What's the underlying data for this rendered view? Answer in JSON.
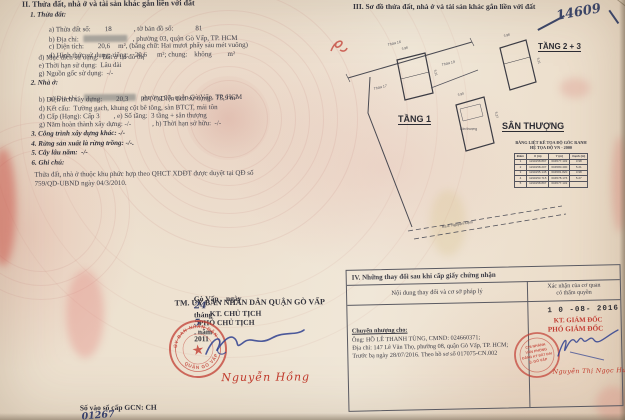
{
  "left": {
    "title": "II. Thửa đất, nhà ở và tài sản khác gắn liền với đất",
    "s1": {
      "h": "1. Thửa đất:",
      "a_l": "a) Thửa đất số:",
      "a_v": "18",
      "a_l2": ", tờ bản đồ số:",
      "a_v2": "81",
      "b_l": "b) Địa chỉ:",
      "b_post": ", phường 03, quận Gò Vấp, TP. HCM",
      "c_l": "c) Diện tích:",
      "c_v": "20,6",
      "c_post": "m², (bằng chữ: Hai mươi phẩy sáu mét vuông)",
      "d_l": "d) Hình thức sử dụng: riêng:",
      "d_v": "20,6",
      "d_post": "m²; chung:    không         m²",
      "dd": "đ) Mục đích sử dụng:  Đất ở tại đô thị",
      "e": "e) Thời hạn sử dụng:  Lâu dài",
      "g": "g) Nguồn gốc sử dụng:  -/-"
    },
    "s2": {
      "h": "2. Nhà ở:",
      "a_l": "a) Địa chỉ:",
      "a_post": "phường 03, quận Gò Vấp, TP. HCM",
      "b": "b) Diện tích xây dựng:        20,3        m², c) Diện tích sử dụng:  75,9 m²",
      "d": "d) Kết cấu:  Tường gạch, khung cột bê tông, sàn BTCT, mái tôn",
      "dd": "đ) Cấp (Hạng): Cấp 3        , e) Số tầng:  3 tầng + sân thượng",
      "g": "g) Năm hoàn thành xây dựng: -/-            , h) Thời hạn sở hữu:  -/-"
    },
    "s3": "3. Công trình xây dựng khác: -/-",
    "s4": "4. Rừng sản xuất là rừng trồng: -/-.",
    "s5": "5. Cây lâu năm:  -/-",
    "s6": "6. Ghi chú:",
    "note1": "Thửa đất, nhà ở thuộc khu phức hợp theo QHCT XDĐT được duyệt tại QĐ số",
    "note2": "759/QD-UBND ngày 04/3/2010.",
    "sign": {
      "p1": "Gò Vấp ,  ngày",
      "day": "24",
      "p2": "tháng",
      "month": "5",
      "p3": ". năm",
      "year": "2011",
      "authority": "TM. ỦY BAN NHÂN DÂN QUẬN GÒ VẤP",
      "title1": "KT. CHỦ TỊCH",
      "title2": "PHÓ CHỦ TỊCH",
      "name": "Nguyễn Hồng",
      "seal_top": "ỦY BAN NHÂN DÂN",
      "seal_bottom": "QUẬN GÒ VẤP"
    },
    "book_label": "Số vào sổ cấp GCN: CH",
    "book_no": "01267"
  },
  "right": {
    "title": "III. Sơ đồ thửa đất, nhà ở và tài sản khác gắn liền với đất",
    "hand_no": "14609",
    "floor1": "TẦNG 1",
    "floor23": "TẦNG 2 + 3",
    "roof": "SÂN THƯỢNG",
    "plan": {
      "roof_small": "Sân thượng",
      "road": "Ra đ. Nguyễn Kiệm",
      "n_top": "Thửa 16",
      "n_right": "Thửa 19",
      "n_left": "Thửa 17",
      "dim_w": "3.98",
      "dim_h": "5.21",
      "dim_w2": "3.90",
      "dim_h2": "5.27"
    },
    "coord_table": {
      "title1": "BẢNG LIỆT KÊ TỌA ĐỘ GÓC RANH",
      "title2": "HỆ TỌA ĐỘ VN - 2000",
      "headers": [
        "Điểm",
        "X (m)",
        "Y (m)",
        "Cạnh (m)"
      ],
      "rows": [
        [
          "1",
          "1190158.897",
          "604577.132",
          "3.98"
        ],
        [
          "2",
          "1190158.207",
          "604580.400",
          "5.21"
        ],
        [
          "3",
          "1190155.145",
          "604581.820",
          "3.98"
        ],
        [
          "4",
          "1190153.715",
          "604578.176",
          "5.27"
        ],
        [
          "5",
          "1190158.897",
          "604577.132",
          ""
        ]
      ]
    },
    "s4": {
      "title": "IV. Những thay đổi sau khi cấp giấy chứng nhận",
      "col1": "Nội dung thay đổi và cơ sở pháp lý",
      "col2a": "Xác nhận của cơ quan",
      "col2b": "có thẩm quyền",
      "transfer_h": "Chuyển nhượng cho:",
      "l1": "Ông: HỒ LÊ THANH TÙNG, CMND: 024660371;",
      "l2": "Địa chỉ: 147 Lê Văn Thọ, phường 08, quận Gò Vấp, TP. HCM;",
      "l3": "Trước bạ ngày 28/07/2016. Theo hồ sơ số 017075-CN.002",
      "date_stamp": "1 0  -08-  2016",
      "appr1": "KT. GIÁM ĐỐC",
      "appr2": "PHÓ GIÁM ĐỐC",
      "name": "Nguyễn Thị Ngọc Hương",
      "stamp1": "CHI NHÁNH",
      "stamp2": "VĂN PHÒNG",
      "stamp3": "ĐĂNG KÝ ĐẤT ĐAI",
      "stamp4": "Q. GÒ VẤP"
    }
  },
  "colors": {
    "stamp_red": "#c23d33",
    "ink_blue": "#2e3f8f",
    "script_red": "#c0392b"
  }
}
